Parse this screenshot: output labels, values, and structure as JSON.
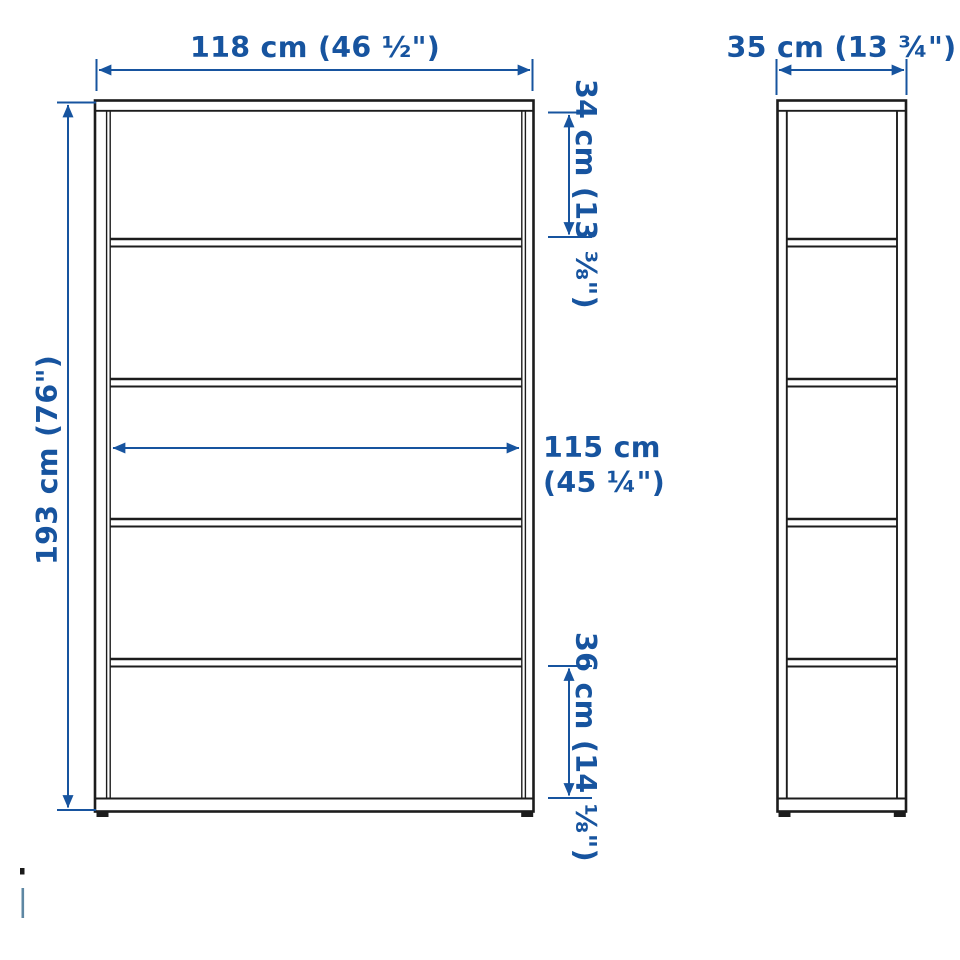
{
  "page": {
    "background": "#ffffff",
    "description": "Furniture dimension diagram of a 5-compartment bookcase shown in front view and side view with metric and imperial measurements"
  },
  "colors": {
    "dimension_blue": "#17549f",
    "outline_black": "#1c1c1c"
  },
  "labels": {
    "front_width": "118 cm (46 ½\")",
    "side_depth": "35 cm (13 ¾\")",
    "total_height": "193 cm (76\")",
    "top_compartment_height": "34 cm (13 ⅜\")",
    "inner_width_line1": "115 cm",
    "inner_width_line2": "(45 ¼\")",
    "bottom_compartment_height": "36 cm (14 ⅛\")"
  },
  "structure": {
    "front_view": {
      "shelves": 4,
      "compartments": 5
    },
    "side_view": {
      "shelves": 4,
      "compartments": 5
    }
  }
}
